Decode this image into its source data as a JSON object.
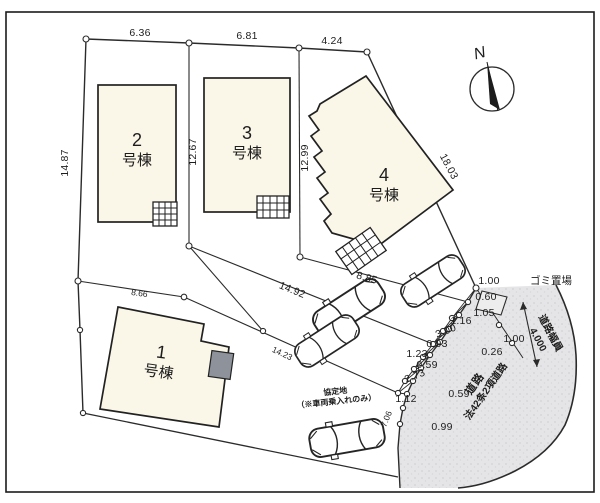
{
  "buildings": [
    {
      "num": "2",
      "suffix": "号棟"
    },
    {
      "num": "3",
      "suffix": "号棟"
    },
    {
      "num": "4",
      "suffix": "号棟"
    },
    {
      "num": "1",
      "suffix": "号棟"
    }
  ],
  "dims": [
    "6.36",
    "6.81",
    "4.24",
    "14.87",
    "12.67",
    "12.99",
    "18.03",
    "14.92",
    "8.85",
    "8.66",
    "14.23",
    "1.00",
    "0.60",
    "1.05",
    "1.16",
    "3.00",
    "0.93",
    "1.23",
    "0.59",
    "2.73",
    "1.12",
    "1.00",
    "0.26",
    "0.59",
    "0.99",
    "7.06"
  ],
  "labels": {
    "garbage": "ゴミ置場",
    "road_width_1": "道路幅員",
    "road_width_2": "4.000",
    "road_1": "道路",
    "road_2": "法42条2項道路",
    "agreement_1": "協定地",
    "agreement_2": "（※車両乗入れのみ）",
    "compass_n": "N"
  },
  "colors": {
    "building_fill": "#faf7e8",
    "road_fill": "#e5e5e7",
    "line": "#2b2b2b"
  }
}
